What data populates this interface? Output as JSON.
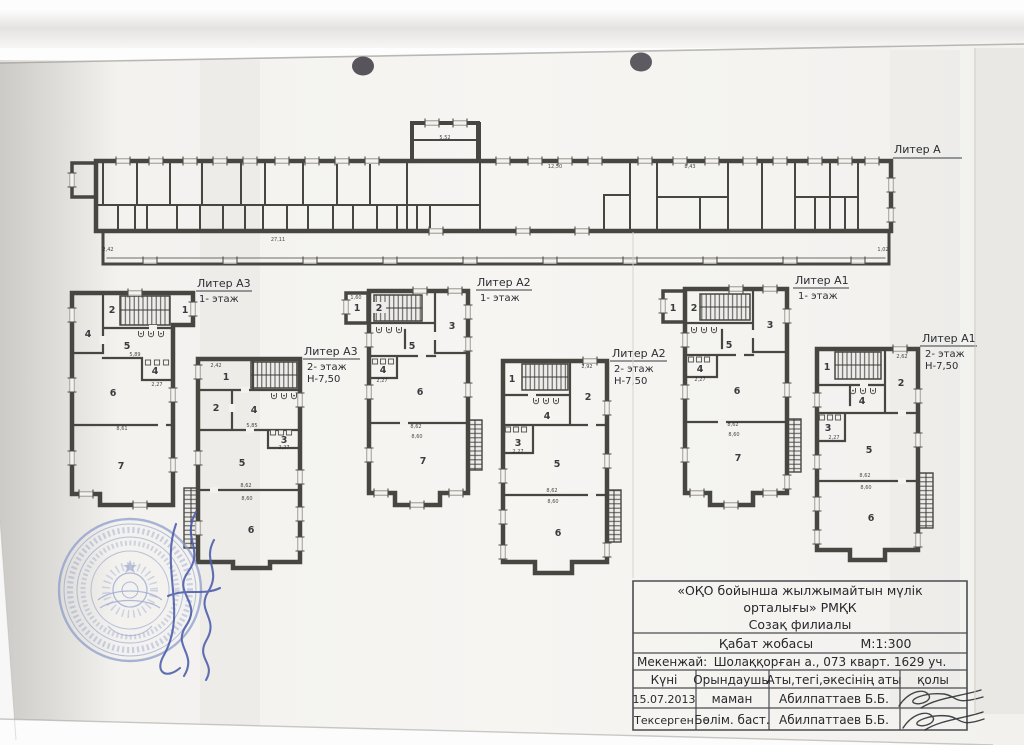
{
  "page": {
    "description": "Scanned architectural floor-plan sheet (technical passport drawing)",
    "paper_color": "#f4f3f0",
    "background": "#fdfdfd"
  },
  "colors": {
    "wall": "#474641",
    "ink": "#26282c",
    "stamp_blue": "#8a9ac9",
    "signature_blue": "#4b5cab",
    "pen_ink": "#2e3338"
  },
  "plans": [
    {
      "id": "liter-a",
      "label": "Литер А",
      "floor": "",
      "height": "",
      "rooms": [],
      "dims": [
        "12,50",
        "8,43",
        "5,52",
        "27,11",
        "2,42",
        "1,02"
      ]
    },
    {
      "id": "liter-a3-1",
      "label": "Литер А3",
      "floor": "1- этаж",
      "height": "",
      "rooms": [
        "2",
        "1",
        "4",
        "5",
        "4",
        "6",
        "7"
      ],
      "dims": [
        "5,89",
        "2,27",
        "8,61"
      ]
    },
    {
      "id": "liter-a3-2",
      "label": "Литер А3",
      "floor": "2- этаж",
      "height": "Н-7,50",
      "rooms": [
        "1",
        "2",
        "4",
        "3",
        "5",
        "6"
      ],
      "dims": [
        "2,42",
        "5,85",
        "2,27",
        "8,62",
        "8,60"
      ]
    },
    {
      "id": "liter-a2-1",
      "label": "Литер А2",
      "floor": "1- этаж",
      "height": "",
      "rooms": [
        "1",
        "2",
        "3",
        "5",
        "4",
        "6",
        "7"
      ],
      "dims": [
        "1,60",
        "2,27",
        "8,62",
        "8,60"
      ]
    },
    {
      "id": "liter-a2-2",
      "label": "Литер А2",
      "floor": "2- этаж",
      "height": "Н-7,50",
      "rooms": [
        "1",
        "2",
        "4",
        "3",
        "5",
        "6"
      ],
      "dims": [
        "2,92",
        "2,27",
        "8,62",
        "8,60"
      ]
    },
    {
      "id": "liter-a1-1",
      "label": "Литер А1",
      "floor": "1- этаж",
      "height": "",
      "rooms": [
        "1",
        "2",
        "3",
        "5",
        "4",
        "6",
        "7"
      ],
      "dims": [
        "2,27",
        "8,62",
        "8,60"
      ]
    },
    {
      "id": "liter-a1-2",
      "label": "Литер А1",
      "floor": "2- этаж",
      "height": "Н-7,50",
      "rooms": [
        "1",
        "2",
        "4",
        "3",
        "5",
        "6"
      ],
      "dims": [
        "2,62",
        "2,27",
        "8,62",
        "8,60"
      ]
    }
  ],
  "title_block": {
    "org_line1": "«ОҚО бойынша жылжымайтын мүлік",
    "org_line2": "орталығы» РМҚК",
    "branch": "Созақ филиалы",
    "doc_title": "Қабат  жобасы",
    "scale": "М:1:300",
    "address_label": "Мекенжай:",
    "address": "Шолаққорған а., 073 кварт. 1629 уч.",
    "table": {
      "headers": [
        "Күні",
        "Орындаушы",
        "Аты,тегі,әкесінің аты",
        "қолы"
      ],
      "rows": [
        [
          "15.07.2013",
          "маман",
          "Абилпаттаев Б.Б."
        ],
        [
          "Тексерген",
          "Бөлім. баст.",
          "Абилпаттаев Б.Б."
        ]
      ]
    }
  },
  "stamp": {
    "shape": "round-seal",
    "ink": "blue"
  }
}
